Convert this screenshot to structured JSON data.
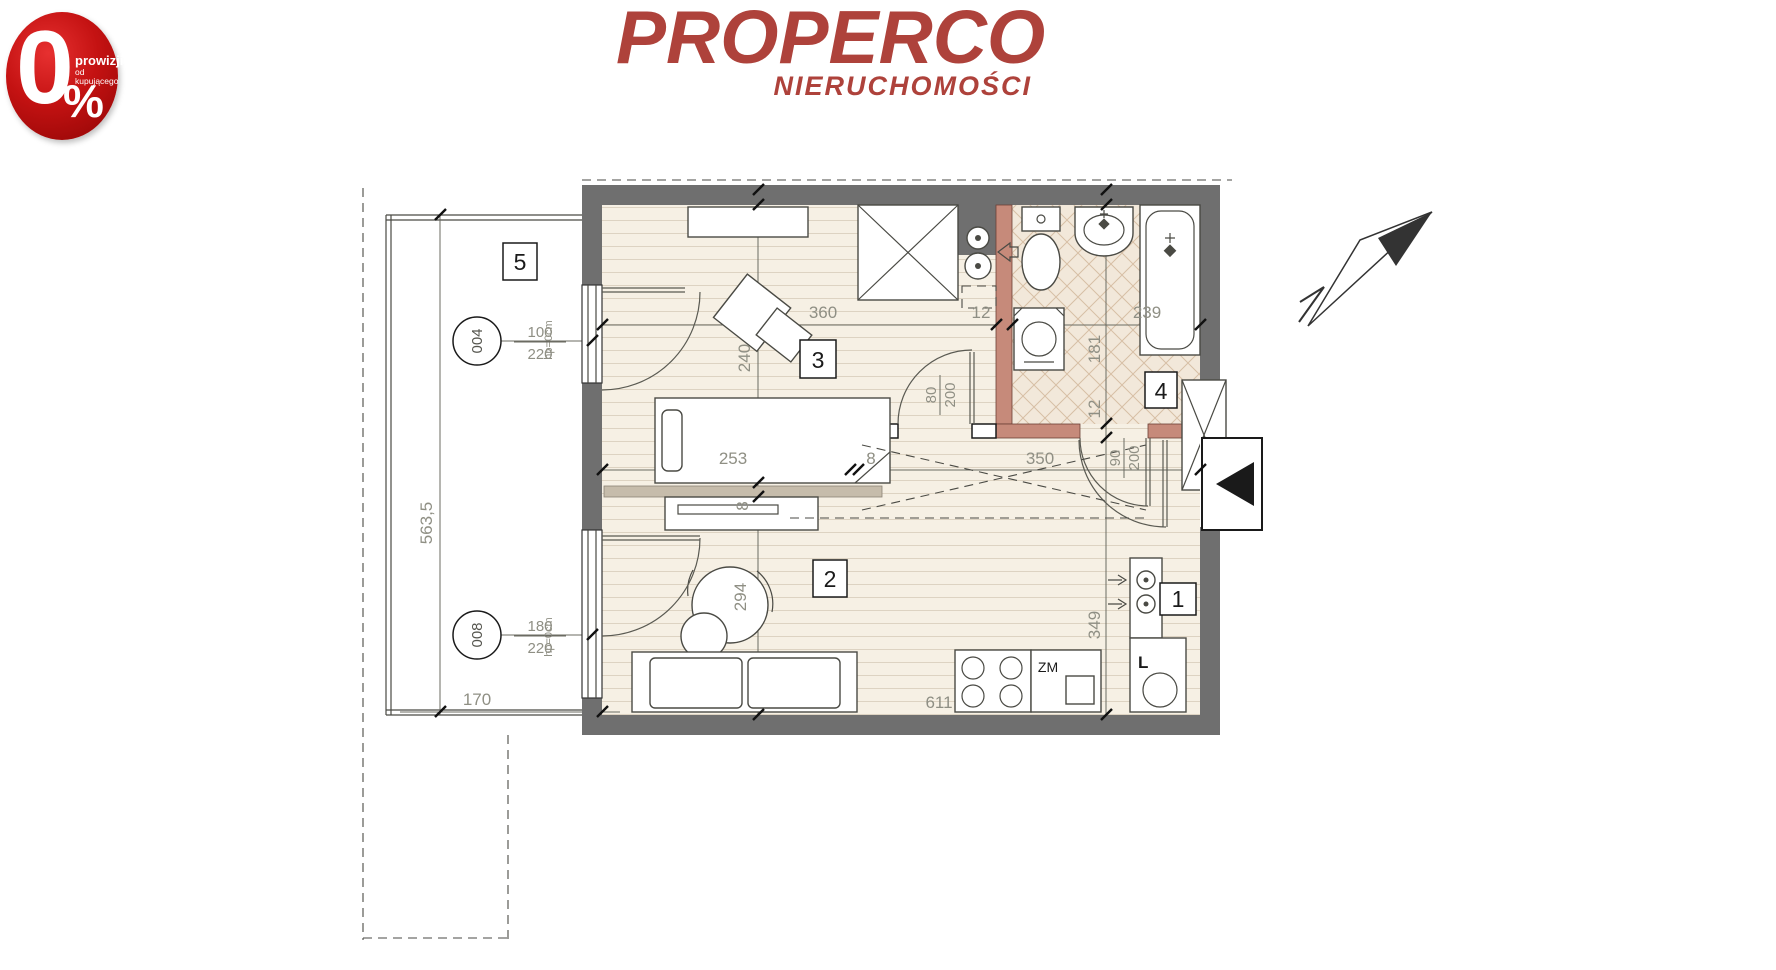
{
  "badge": {
    "zero": "0",
    "percent_sign": "%",
    "line1": "prowizji",
    "line2": "od kupującego"
  },
  "logo": {
    "brand": "PROPERCO",
    "subtitle": "NIERUCHOMOŚCI"
  },
  "plan": {
    "rooms": [
      {
        "id": "1"
      },
      {
        "id": "2"
      },
      {
        "id": "3"
      },
      {
        "id": "4"
      },
      {
        "id": "5"
      }
    ],
    "openings": [
      {
        "tag": "004",
        "width": "100",
        "height": "220",
        "sill": "hp=0cm"
      },
      {
        "tag": "008",
        "width": "180",
        "height": "220",
        "sill": "hp=0cm"
      }
    ],
    "doors": [
      {
        "w": "80",
        "h": "200"
      },
      {
        "w": "90",
        "h": "200"
      }
    ],
    "dims": {
      "top": [
        "360",
        "12",
        "239"
      ],
      "middle": [
        "253",
        "8",
        "350"
      ],
      "left_chain": [
        "240",
        "8",
        "294"
      ],
      "right_chain": [
        "181",
        "12",
        "349"
      ],
      "bottom": [
        "611"
      ],
      "balcony_height": "563,5",
      "balcony_width": "170"
    },
    "kitchen": {
      "sink_label": "ZM",
      "fridge_label": "L"
    }
  }
}
